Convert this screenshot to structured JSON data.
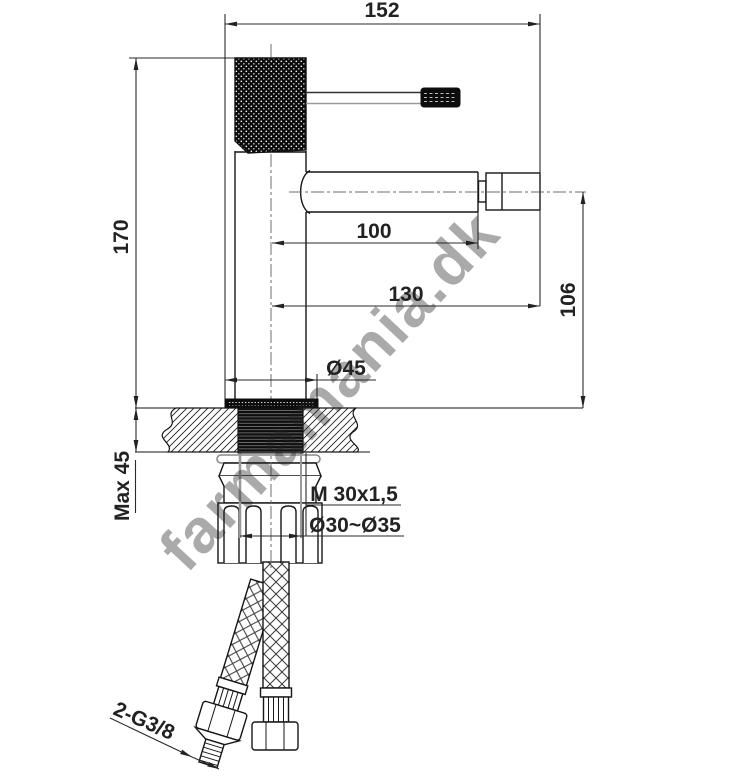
{
  "drawing": {
    "type": "faucet-technical-dimension-drawing",
    "watermark": "farmamania.dk",
    "dimensions": {
      "overall_width": "152",
      "body_height": "170",
      "spout_reach": "100",
      "spout_overall": "130",
      "spout_height": "106",
      "max_deck_thickness": "Max 45",
      "base_diameter": "Ø45",
      "mounting_thread": "M 30x1,5",
      "hole_diameter_range": "Ø30~Ø35",
      "supply_hose_thread": "2-G3/8"
    },
    "colors": {
      "line": "#1c1c1c",
      "dimension": "#2a2a2a",
      "centerline": "#6e6e6e",
      "hidden_gray": "#9a9a9a",
      "watermark_gray": "#9b9b9b"
    }
  }
}
